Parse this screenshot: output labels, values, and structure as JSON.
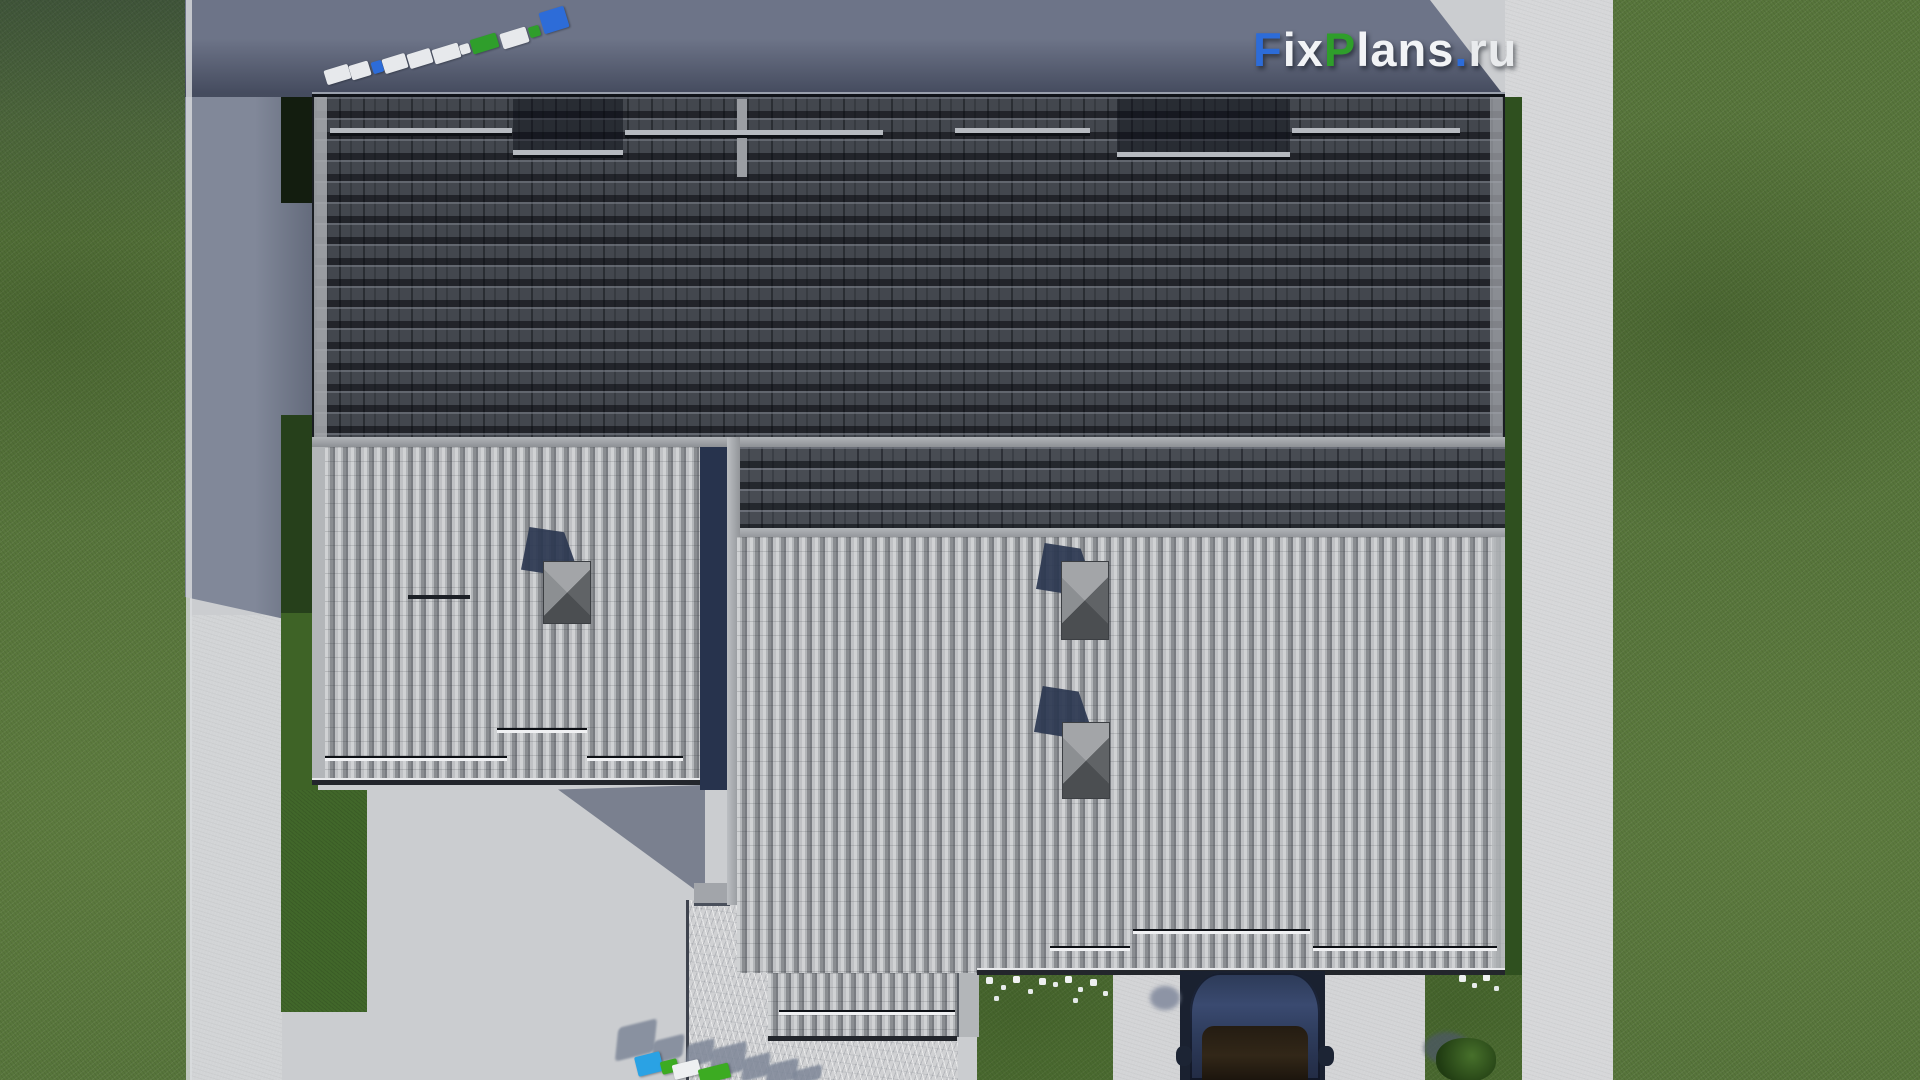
{
  "watermark": {
    "full_text": "FixPlans.ru",
    "segments": [
      {
        "text": "F",
        "color": "#2d6cd8"
      },
      {
        "text": "ix",
        "color": "#f2f4f6"
      },
      {
        "text": "P",
        "color": "#2f9e2b"
      },
      {
        "text": "lans",
        "color": "#f2f4f6"
      },
      {
        "text": ".",
        "color": "#2d6cd8"
      },
      {
        "text": "ru",
        "color": "#e9ebed"
      }
    ]
  },
  "scene": {
    "type": "aerial top-down 3D render of a single-storey house roof plan on a paved plot",
    "lighting": "sun from lower-right, long blue-gray shadows cast toward upper-left",
    "objects": [
      {
        "name": "dark-tile-roof",
        "label": "Main roof slope with dark concrete tiles",
        "color": "#43474e"
      },
      {
        "name": "light-metal-roof-left",
        "label": "Left wing corrugated light-gray metal roof",
        "color": "#a9acb0"
      },
      {
        "name": "light-metal-roof-right",
        "label": "Right wing corrugated light-gray metal roof",
        "color": "#a9acb0"
      },
      {
        "name": "snow-guards",
        "label": "Horizontal snow-guard bars on all roof slopes"
      },
      {
        "name": "chimneys",
        "label": "Three chimneys with pyramidal gray caps",
        "count": 3
      },
      {
        "name": "car",
        "label": "Dark navy car parked at the garage entrance",
        "color": "#32405e"
      },
      {
        "name": "garage-opening",
        "label": "Recessed garage bay under right roof",
        "color": "#1a2130"
      },
      {
        "name": "driveway",
        "label": "Concrete driveway and side walkways",
        "color": "#d3d4d6"
      },
      {
        "name": "stone-walkway",
        "label": "Stone/marble textured rear patio walkway",
        "color": "#d0d1d3"
      },
      {
        "name": "lawn",
        "label": "Lawn fields on left and right plot edges",
        "color": "#57753b"
      },
      {
        "name": "hedge-beds",
        "label": "Green planting beds along house walls",
        "color": "#3f6527"
      },
      {
        "name": "flower-bed",
        "label": "White flowers in rear planting beds"
      },
      {
        "name": "bush",
        "label": "Shrub in bottom-right lawn bed"
      },
      {
        "name": "logo-3d-blocks-top",
        "label": "3D FixPlans logo blocks lying on pavement, top-left"
      },
      {
        "name": "logo-3d-blocks-bottom",
        "label": "3D FixPlans logo blocks lying on pavement, bottom"
      }
    ],
    "palette": {
      "pavement_lit": "#cbcdd0",
      "pavement_bright": "#d6d7d9",
      "pavement_shadow": "#7d8497",
      "shadow_deep": "#565d72",
      "grass": "#57753b",
      "hedge_dark": "#15220f",
      "roof_dark": "#43474e",
      "roof_light": "#a9acb0",
      "fascia_gray": "#aaadb1",
      "accent_blue": "#2d6cd8",
      "accent_green": "#2f9e2b",
      "accent_cyan": "#2aa2e4",
      "car_body": "#32405e"
    }
  }
}
